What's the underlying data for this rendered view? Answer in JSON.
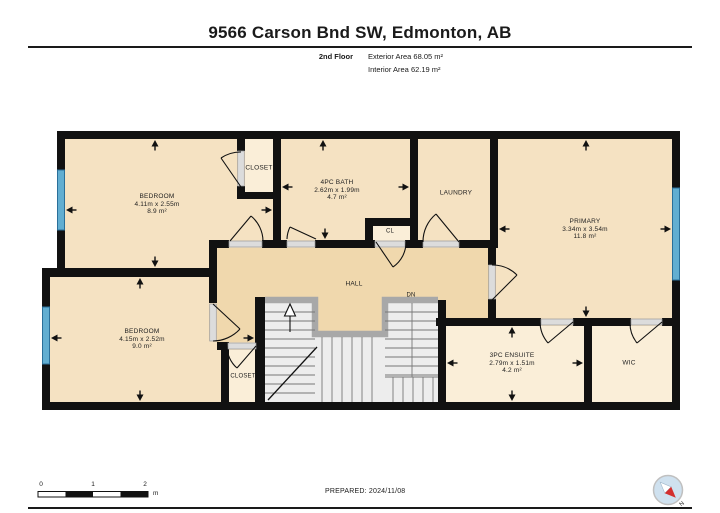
{
  "header": {
    "title": "9566 Carson Bnd SW, Edmonton, AB",
    "floor_label": "2nd Floor",
    "exterior_area": "Exterior Area 68.05 m²",
    "interior_area": "Interior Area 62.19 m²"
  },
  "rooms": {
    "bedroom1": {
      "name": "BEDROOM",
      "dims": "4.11m x 2.55m",
      "area": "8.9 m²"
    },
    "closet1": {
      "name": "CLOSET"
    },
    "bath": {
      "name": "4PC BATH",
      "dims": "2.62m x 1.99m",
      "area": "4.7 m²"
    },
    "cl": {
      "name": "CL"
    },
    "laundry": {
      "name": "LAUNDRY"
    },
    "primary": {
      "name": "PRIMARY",
      "dims": "3.34m x 3.54m",
      "area": "11.8 m²"
    },
    "hall": {
      "name": "HALL"
    },
    "stairs": {
      "down_label": "DN"
    },
    "bedroom2": {
      "name": "BEDROOM",
      "dims": "4.15m x 2.52m",
      "area": "9.0 m²"
    },
    "closet2": {
      "name": "CLOSET"
    },
    "ensuite": {
      "name": "3PC ENSUITE",
      "dims": "2.79m x 1.51m",
      "area": "4.2 m²"
    },
    "wic": {
      "name": "WIC"
    }
  },
  "footer": {
    "prepared": "PREPARED: 2024/11/08",
    "scale_bar": {
      "tick0": "0",
      "tick1": "1",
      "tick2": "2",
      "unit": "m"
    },
    "compass": {
      "north_label": "N"
    }
  },
  "colors": {
    "wall": "#111111",
    "room_fill": "#f5e2c2",
    "hall_fill": "#f0d8ad",
    "closet_fill": "#faeed8",
    "window_blue": "#62aed1",
    "stair_floor": "#ededed",
    "door_opening": "#dcdcdc",
    "compass_red": "#d32f2f"
  }
}
